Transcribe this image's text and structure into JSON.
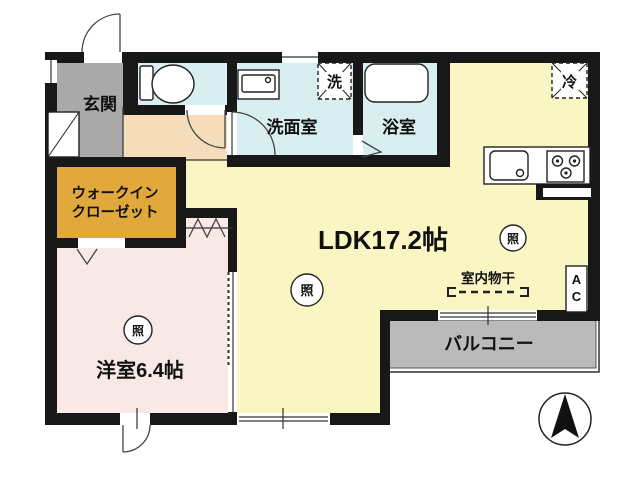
{
  "rooms": {
    "genkan": "玄関",
    "wic_line1": "ウォークイン",
    "wic_line2": "クローゼット",
    "senmenshitsu": "洗面室",
    "yokushitsu": "浴室",
    "ldk": "LDK17.2帖",
    "yoshitsu": "洋室6.4帖",
    "balcony": "バルコニー"
  },
  "fixtures": {
    "washer": "洗",
    "fridge": "冷",
    "light": "照",
    "indoor_drying": "室内物干",
    "ac_top": "A",
    "ac_bottom": "C"
  },
  "colors": {
    "wall": "#181818",
    "genkan": "#a9a9a9",
    "hall": "#f5dcba",
    "water": "#d8eef0",
    "ldk": "#faf6c3",
    "yoshitsu": "#f8e8e6",
    "closet": "#e1a93b",
    "balcony": "#bababa"
  }
}
